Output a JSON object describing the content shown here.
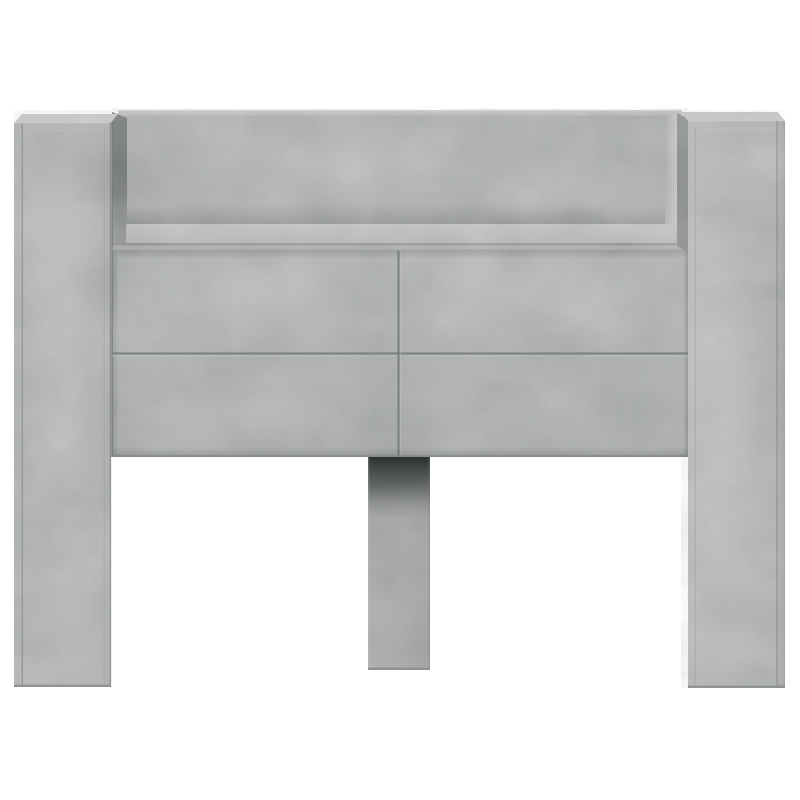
{
  "product_photo": {
    "alt": "Headboard cabinet in concrete grey, front view on white studio background: two tall side pillars, open top storage compartment with shelf, four flat front panels and a centre support leg",
    "finish_name": "concrete grey",
    "parts": {
      "left_pillar": "left side pillar leg",
      "right_pillar": "right side pillar leg",
      "top_compartment": "open shelf compartment",
      "front_panels": "four front cabinet panels",
      "center_leg": "centre support leg"
    }
  },
  "palette": {
    "background": "#ffffff",
    "concrete-face": "#b2b4b3",
    "concrete-face-light": "#b6b8b7",
    "concrete-top-face": "#c5c7c6",
    "concrete-top-strip": "#c6c8c7",
    "concrete-back-panel": "#a9acab",
    "concrete-shelf": "#bfc1c0",
    "concrete-side-strip": "#a3a6a5",
    "concrete-inner-wall-dark": "#666a69",
    "concrete-inner-wall-light": "#c6c8c7",
    "concrete-pillar-side-dark": "#7d807f",
    "concrete-leg": "#999c9b",
    "leg-contact-shadow": "#262a29",
    "seam-color": "#777b7a",
    "edge-shadow": "#8a8d8c"
  }
}
